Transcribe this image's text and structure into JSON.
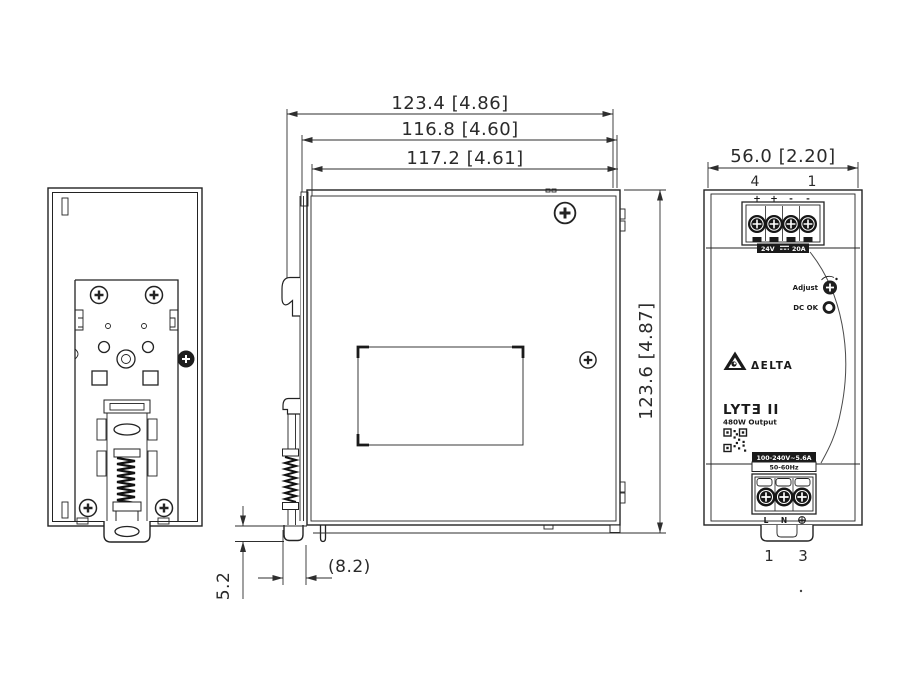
{
  "drawing": {
    "background": "#ffffff",
    "line_color": "#232323",
    "dim_color": "#2e2e2e"
  },
  "dimensions": {
    "top": [
      {
        "label": "123.4 [4.86]"
      },
      {
        "label": "116.8 [4.60]"
      },
      {
        "label": "117.2 [4.61]"
      }
    ],
    "height": {
      "label": "123.6 [4.87]"
    },
    "front_width": {
      "label": "56.0 [2.20]"
    },
    "clip_depth": {
      "label": "5.2"
    },
    "clip_offset": {
      "label": "(8.2)"
    }
  },
  "front_panel": {
    "top_pins": {
      "left": "4",
      "right": "1"
    },
    "output_polarity": [
      "+",
      "+",
      "-",
      "-"
    ],
    "output_rating": {
      "voltage": "24V",
      "current": "20A"
    },
    "adjust_label": "Adjust",
    "dc_ok_label": "DC OK",
    "brand": "ΔELTA",
    "model": "LYTƎ II",
    "power": "480W Output",
    "input_rating": {
      "line1": "100-240V~5.6A",
      "line2": "50-60Hz"
    },
    "input_terminals": {
      "line": "L",
      "neutral": "N"
    },
    "bottom_pins": {
      "left": "1",
      "right": "3"
    }
  }
}
